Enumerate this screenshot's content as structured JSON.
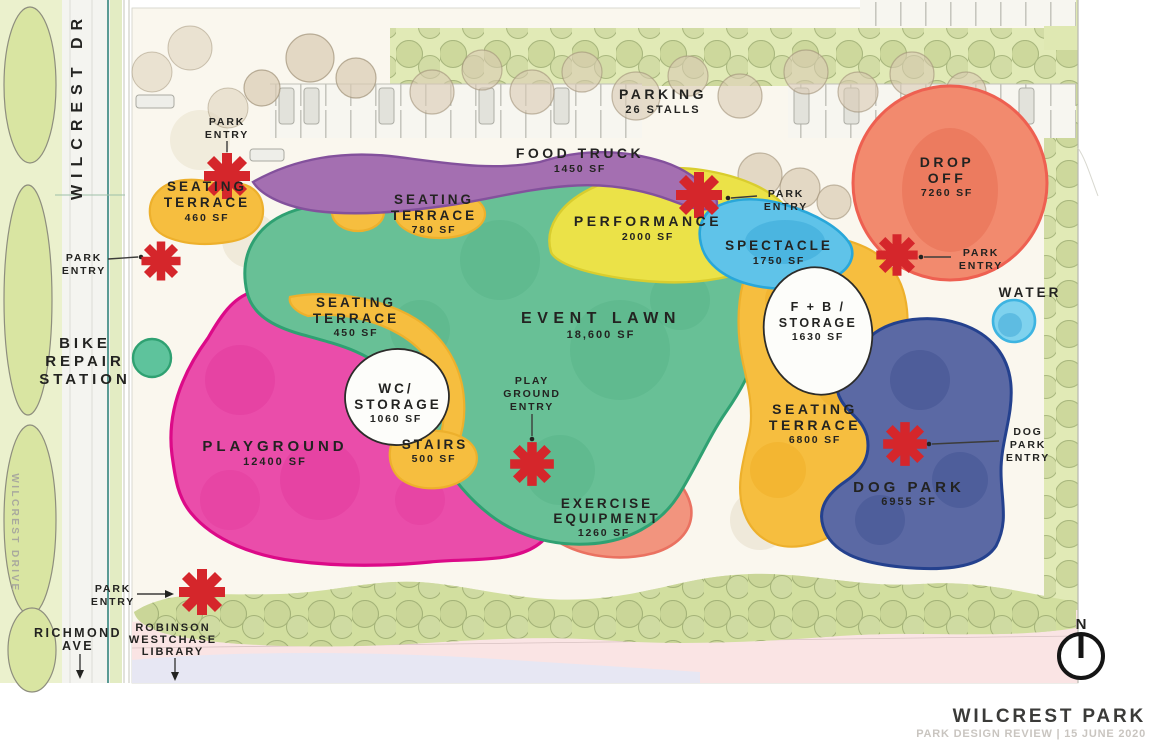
{
  "title_block": {
    "title": "WILCREST PARK",
    "subtitle": "PARK DESIGN REVIEW | 15 JUNE 2020"
  },
  "compass": {
    "north": "N"
  },
  "streets": {
    "wilcrest_dr": "WILCREST DR",
    "wilcrest_drive_faint": "WILCREST DRIVE",
    "richmond_line1": "RICHMOND",
    "richmond_line2": "AVE"
  },
  "context": {
    "parking_title": "PARKING",
    "parking_detail": "26 STALLS",
    "bike_line1": "BIKE",
    "bike_line2": "REPAIR",
    "bike_line3": "STATION",
    "library_line1": "ROBINSON",
    "library_line2": "WESTCHASE",
    "library_line3": "LIBRARY",
    "water_label": "WATER",
    "water_color": "#7fd2ee"
  },
  "entry_labels": {
    "park_line1": "PARK",
    "park_line2": "ENTRY",
    "play_line1": "PLAY",
    "play_line2": "GROUND",
    "play_line3": "ENTRY",
    "dog_line1": "DOG",
    "dog_line2": "PARK",
    "dog_line3": "ENTRY",
    "marker_color": "#d5262b"
  },
  "zones": {
    "food_truck": {
      "name": "FOOD TRUCK",
      "area": "1450 SF",
      "color": "#a46fb1"
    },
    "seating_terrace_nw": {
      "name_line1": "SEATING",
      "name_line2": "TERRACE",
      "area": "460 SF",
      "color": "#f6be3f"
    },
    "seating_terrace_north": {
      "name_line1": "SEATING",
      "name_line2": "TERRACE",
      "area": "780 SF",
      "color": "#f6be3f"
    },
    "seating_terrace_west": {
      "name_line1": "SEATING",
      "name_line2": "TERRACE",
      "area": "450 SF",
      "color": "#f6be3f"
    },
    "seating_terrace_east": {
      "name_line1": "SEATING",
      "name_line2": "TERRACE",
      "area": "6800 SF",
      "color": "#f6be3f"
    },
    "performance": {
      "name": "PERFORMANCE",
      "area": "2000 SF",
      "color": "#ebe248"
    },
    "spectacle": {
      "name": "SPECTACLE",
      "area": "1750 SF",
      "color": "#5fc3e9"
    },
    "drop_off": {
      "name_line1": "DROP",
      "name_line2": "OFF",
      "area": "7260 SF",
      "color": "#f28a6e"
    },
    "event_lawn": {
      "name": "EVENT LAWN",
      "area": "18,600 SF",
      "color": "#68c096"
    },
    "fb_storage": {
      "name_line1": "F + B /",
      "name_line2": "STORAGE",
      "area": "1630 SF",
      "color": "#fdfdfa"
    },
    "wc_storage": {
      "name_line1": "WC/",
      "name_line2": "STORAGE",
      "area": "1060 SF",
      "color": "#fdfdfa"
    },
    "stairs": {
      "name": "STAIRS",
      "area": "500 SF",
      "color": "#f6be3f"
    },
    "playground": {
      "name": "PLAYGROUND",
      "area": "12400 SF",
      "color": "#ea4daa"
    },
    "exercise": {
      "name_line1": "EXERCISE",
      "name_line2": "EQUIPMENT",
      "area": "1260 SF",
      "color": "#f2947e"
    },
    "dog_park": {
      "name": "DOG PARK",
      "area": "6955 SF",
      "color": "#5b69a4"
    }
  }
}
